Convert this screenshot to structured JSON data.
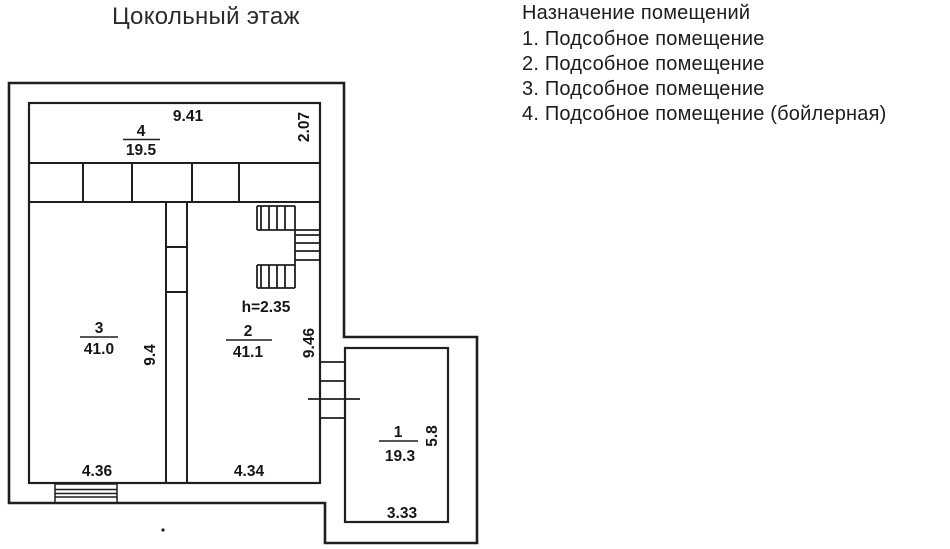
{
  "title": "Цокольный этаж",
  "legend": {
    "heading": "Назначение помещений",
    "items": [
      "1. Подсобное помещение",
      "2. Подсобное помещение",
      "3. Подсобное помещение",
      "4. Подсобное помещение (бойлерная)"
    ]
  },
  "plan": {
    "rooms": [
      {
        "number": "1",
        "area": "19.3",
        "width_m": "3.33",
        "height_m": "5.8"
      },
      {
        "number": "2",
        "area": "41.1",
        "width_m": "4.34",
        "height_m": "9.46"
      },
      {
        "number": "3",
        "area": "41.0",
        "width_m": "4.36",
        "height_m": "9.4"
      },
      {
        "number": "4",
        "area": "19.5",
        "width_m": "9.41",
        "height_m": "2.07"
      }
    ],
    "ceiling_height_note": "h=2.35"
  },
  "colors": {
    "line": "#1f1f1f",
    "text": "#161616",
    "background": "#ffffff"
  }
}
